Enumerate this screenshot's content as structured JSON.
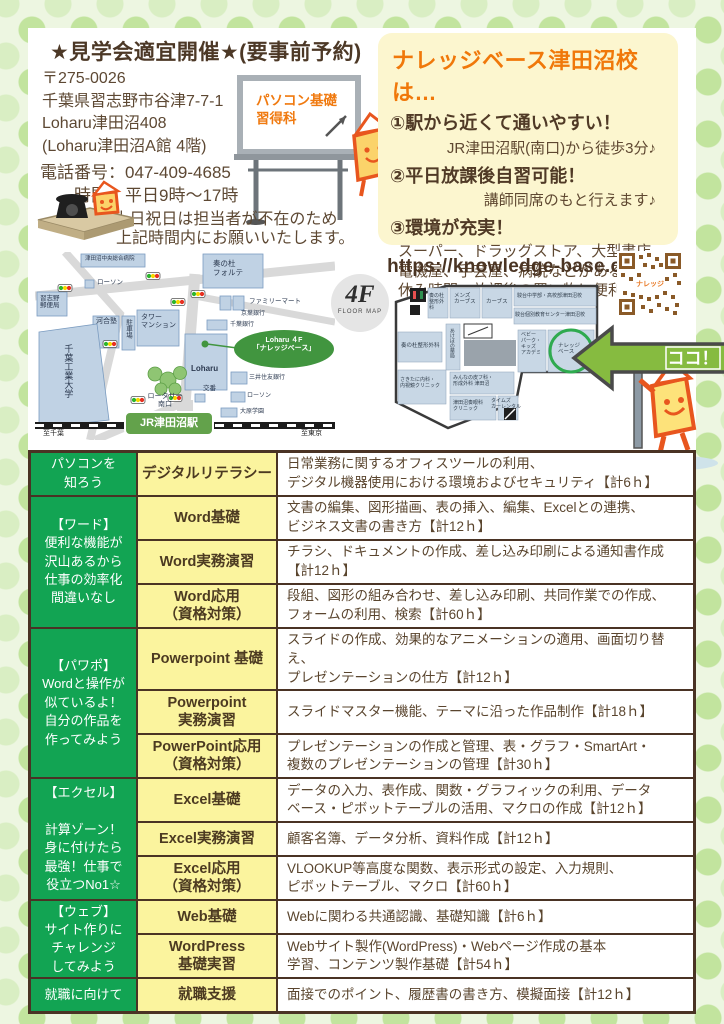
{
  "colors": {
    "accent_orange": "#f0780a",
    "table_green": "#12a453",
    "table_yellow": "#fbf49e",
    "text_brown": "#5d4833",
    "border_brown": "#4a3324",
    "map_oval_green": "#41953f",
    "station_green": "#63a24b",
    "arrow_green": "#86bb40"
  },
  "header": {
    "title": "★見学会適宜開催★(要事前予約)"
  },
  "contact": {
    "postal": "〒275-0026",
    "address1": "千葉県習志野市谷津7-7-1",
    "address2": "Loharu津田沼408",
    "address3": "(Loharu津田沼A館 4階)",
    "phone": "電話番号：047-409-4685",
    "hours": "時間：平日9時～17時",
    "note1": "※土日祝日は担当者が不在のため",
    "note2": "上記時間内にお願いいたします。"
  },
  "whiteboard": {
    "text": "パソコン基礎\n習得科"
  },
  "features_box": {
    "title": "ナレッジベース津田沼校は…",
    "item1_head": "①駅から近くて通いやすい！",
    "item1_detail": "JR津田沼駅(南口)から徒歩3分♪",
    "item2_head": "②平日放課後自習可能！",
    "item2_detail": "講師同席のもと行えます♪",
    "item3_head": "③環境が充実！",
    "item3_detail": "スーパー、ドラッグストア、大型書店、\n電機屋、手芸屋、病院などがあるため\n休み時間・放課後の買い物に便利♪"
  },
  "map": {
    "labels": {
      "hospital": "津田沼中央総合病院",
      "lawson1": "ローソン",
      "post_office": "習志野\n郵便局",
      "kawai": "河合塾",
      "parking": "駐車場",
      "tower": "タワー\nマンション",
      "chiba_tech": "千葉工業大学",
      "forte": "奏の杜\nフォルテ",
      "familymart": "ファミリーマート",
      "keiyo_bank": "京葉銀行",
      "chiba_bank": "千葉銀行",
      "loharu": "Loharu",
      "oval": "Loharu ４F\n「ナレッジベース」",
      "smbc": "三井住友銀行",
      "koban": "交番",
      "lawson2": "ローソン",
      "ohara": "大原学園",
      "rotary": "ロータリー\n南口",
      "station": "JR津田沼駅",
      "to_chiba": "至千葉",
      "to_tokyo": "至東京"
    }
  },
  "floor": {
    "url": "https://knowledge-base.co/",
    "badge": "4F",
    "badge_sub": "FLOOR MAP",
    "here": "ココ！",
    "qr_label": "ナレッジ",
    "rooms": {
      "seikei_top": "奏の杜整形外科",
      "mens_curves": "メンズ\nカーブス",
      "curves": "カーブス",
      "sundai1": "駿台中学部・高校部津田沼校",
      "sundai2": "駿台個別教育センター津田沼校",
      "akebono": "あけぼの薬局",
      "seikei_left": "奏の杜整形外科",
      "baby": "ベビー\nパーク・\nキッズ\nアカデミ",
      "knowledge": "ナレッジ\nベース",
      "sakitani": "さきたに内科・\n内視鏡クリニック",
      "minna": "みんなの皮フ科・\n形成外科 津田沼",
      "kanade_eye": "津田沼奏眼科\nクリニック",
      "times": "タイムズ\nカーレンタル"
    }
  },
  "courses": {
    "categories": [
      {
        "label": "パソコンを\n知ろう"
      },
      {
        "label": "【ワード】\n便利な機能が\n沢山あるから\n仕事の効率化\n間違いなし"
      },
      {
        "label": "【パワポ】\nWordと操作が\n似ているよ！\n自分の作品を\n作ってみよう"
      },
      {
        "label": "【エクセル】\n\n計算ゾーン！\n身に付けたら\n最強！仕事で\n役立つNo1☆"
      },
      {
        "label": "【ウェブ】\nサイト作りに\nチャレンジ\nしてみよう"
      },
      {
        "label": "就職に向けて"
      }
    ],
    "rows": [
      {
        "name": "デジタルリテラシー",
        "desc": "日常業務に関するオフィスツールの利用、\nデジタル機器使用における環境およびセキュリティ【計6ｈ】"
      },
      {
        "name": "Word基礎",
        "desc": "文書の編集、図形描画、表の挿入、編集、Excelとの連携、\nビジネス文書の書き方【計12ｈ】"
      },
      {
        "name": "Word実務演習",
        "desc": "チラシ、ドキュメントの作成、差し込み印刷による通知書作成\n【計12ｈ】"
      },
      {
        "name": "Word応用\n（資格対策）",
        "desc": "段組、図形の組み合わせ、差し込み印刷、共同作業での作成、\nフォームの利用、検索【計60ｈ】"
      },
      {
        "name": "Powerpoint 基礎",
        "desc": "スライドの作成、効果的なアニメーションの適用、画面切り替え、\nプレゼンテーションの仕方【計12ｈ】"
      },
      {
        "name": "Powerpoint\n実務演習",
        "desc": "スライドマスター機能、テーマに沿った作品制作【計18ｈ】"
      },
      {
        "name": "PowerPoint応用\n（資格対策）",
        "desc": "プレゼンテーションの作成と管理、表・グラフ・SmartArt・\n複数のプレゼンテーションの管理【計30ｈ】"
      },
      {
        "name": "Excel基礎",
        "desc": "データの入力、表作成、関数・グラフィックの利用、データ\nベース・ピボットテーブルの活用、マクロの作成【計12ｈ】"
      },
      {
        "name": "Excel実務演習",
        "desc": "顧客名簿、データ分析、資料作成【計12ｈ】"
      },
      {
        "name": "Excel応用\n（資格対策）",
        "desc": "VLOOKUP等高度な関数、表示形式の設定、入力規則、\nピボットテーブル、マクロ【計60ｈ】"
      },
      {
        "name": "Web基礎",
        "desc": "Webに関わる共通認識、基礎知識【計6ｈ】"
      },
      {
        "name": "WordPress\n基礎実習",
        "desc": "Webサイト製作(WordPress)・Webページ作成の基本\n学習、コンテンツ製作基礎【計54ｈ】"
      },
      {
        "name": "就職支援",
        "desc": "面接でのポイント、履歴書の書き方、模擬面接【計12ｈ】"
      }
    ]
  }
}
